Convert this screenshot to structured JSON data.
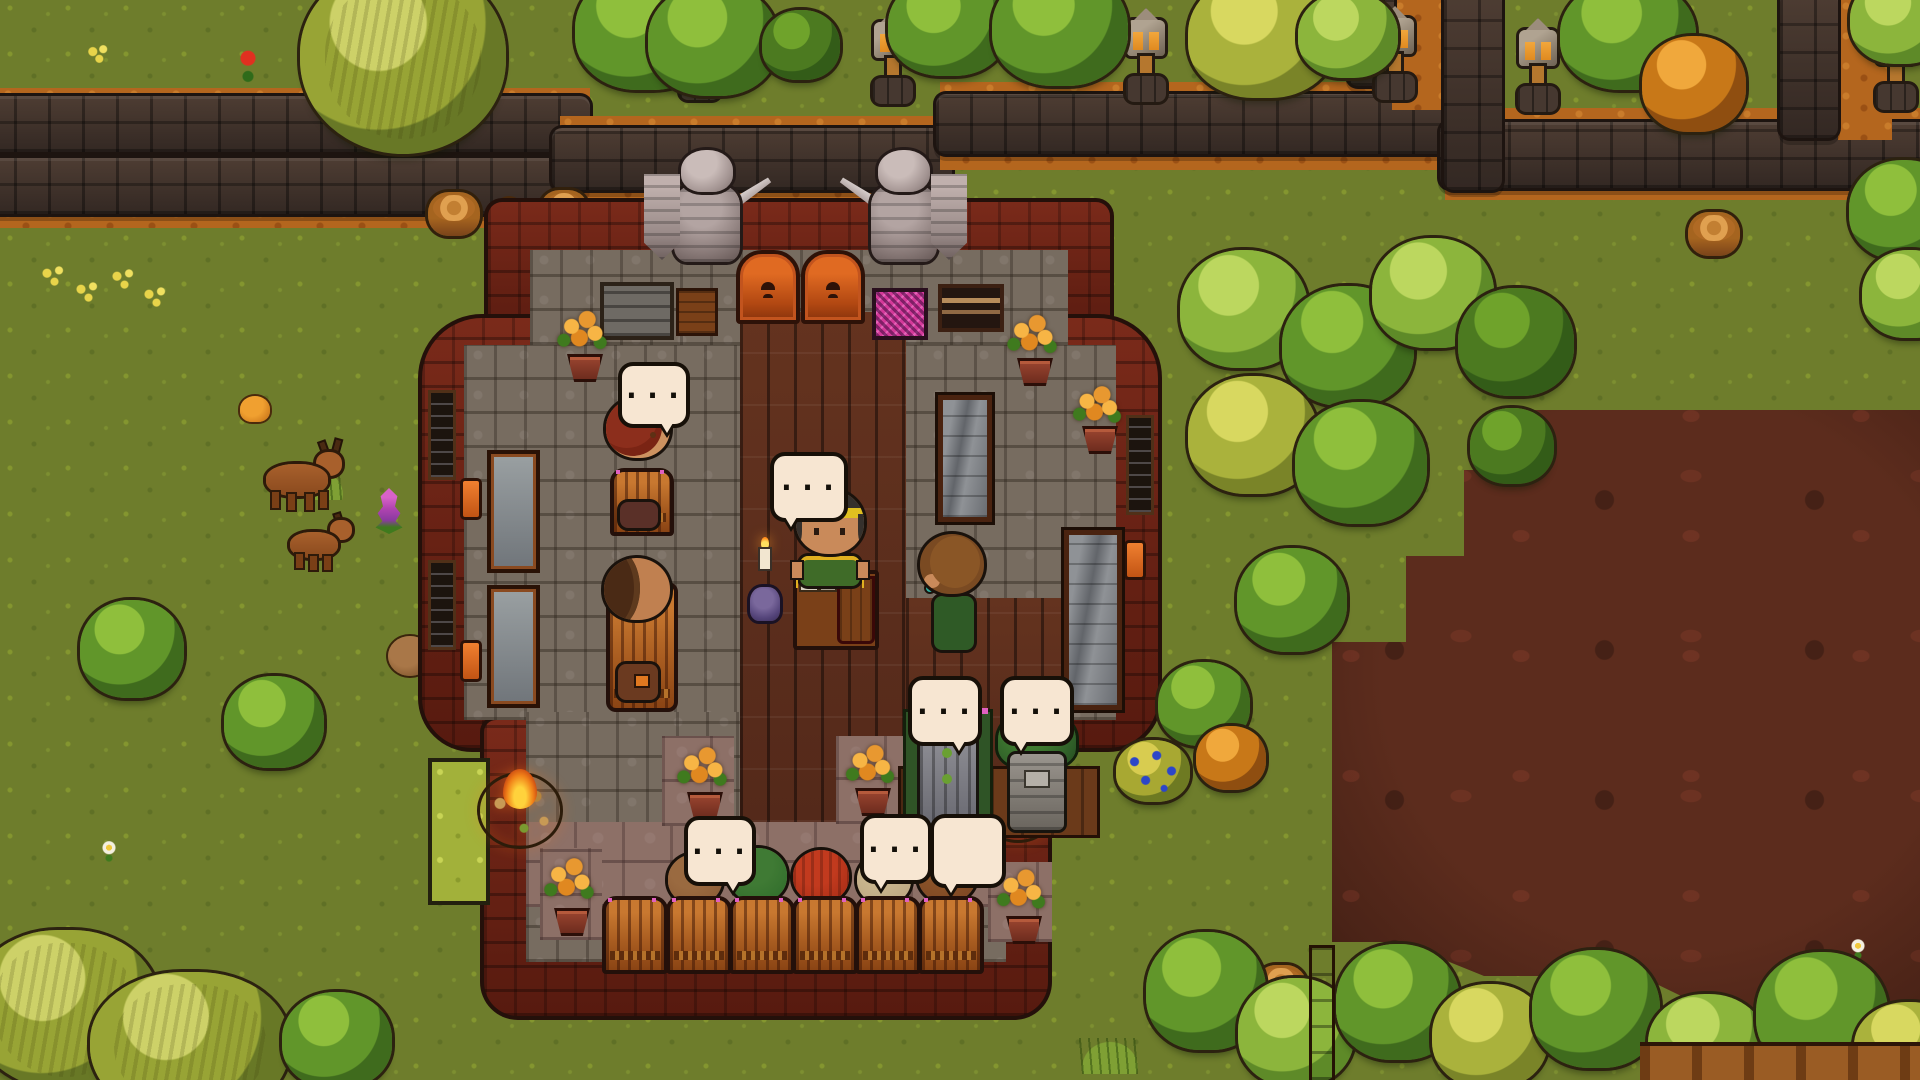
{
  "meta": {
    "domain": "Game",
    "scene_description": "Top-down pixel-art village scene: a brick tavern with stone floor, merchant counter, patrons with speech bubbles, knight statues at the entrance, surrounded by grass, dirt paths with stone walls, forests, two deer and a large mud field",
    "resolution": "1920x1080"
  },
  "speech": {
    "dots": "...",
    "empty": ""
  },
  "bubbles": [
    {
      "owner": "red-haired villager",
      "text": "..."
    },
    {
      "owner": "tavern merchant",
      "text": "..."
    },
    {
      "owner": "armored patron",
      "text": "..."
    },
    {
      "owner": "hooded patron",
      "text": "..."
    },
    {
      "owner": "seated patron left",
      "text": "..."
    },
    {
      "owner": "seated patron middle",
      "text": "..."
    },
    {
      "owner": "seated patron right",
      "text": ""
    }
  ],
  "characters": [
    {
      "name": "red-haired villager",
      "state": "standing, facing down"
    },
    {
      "name": "bald fur-collar villager",
      "state": "sitting on chair"
    },
    {
      "name": "tavern merchant",
      "state": "standing behind counter, green dress, green-yellow headband"
    },
    {
      "name": "brown-haired villager",
      "state": "standing, green shirt"
    },
    {
      "name": "armored patron",
      "state": "seated on green chair"
    },
    {
      "name": "hooded patron",
      "state": "seated, grey pack"
    },
    {
      "name": "five seated patrons",
      "state": "sitting in chair row at bottom wall"
    }
  ],
  "animals": [
    {
      "name": "deer adult",
      "note": "with antlers"
    },
    {
      "name": "deer fawn",
      "note": "smaller, no antlers"
    }
  ],
  "props": {
    "statues": 2,
    "doors": 2,
    "chairs_bottom_row": 6,
    "flower_pots": 7,
    "campfires": 2,
    "lantern_posts": 7,
    "display_cases": 3,
    "long_tables": 2,
    "poster": "magenta pixel poster",
    "candle_stand": "purple candelabra with lit candle"
  },
  "palette": {
    "grass": "#6e7d2c",
    "path": "#b4661e",
    "stone_wall": "#3c2f28",
    "brick": "#672114",
    "floor_stone": "#776c60",
    "floor_wood": "#5d2f1d",
    "mud": "#542a1c",
    "bubble": "#f7e6d2",
    "bubble_outline": "#171008",
    "flame": "#f08018",
    "foliage_green": "#61962a",
    "foliage_yellow": "#aab23c"
  }
}
